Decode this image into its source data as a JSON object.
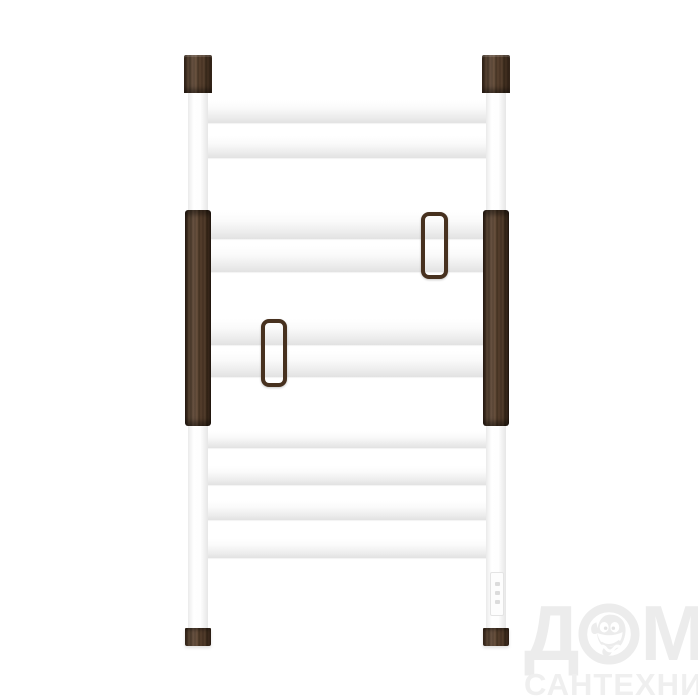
{
  "canvas": {
    "width": 698,
    "height": 698,
    "background": "#ffffff"
  },
  "product": {
    "kind": "ladder-towel-rail-photo",
    "colors": {
      "wood_dark": "#392716",
      "wood_mid": "#543b28",
      "wood_light": "#5f4530",
      "bar_highlight": "#ffffff",
      "bar_shade": "#e2e2e2",
      "hook_wood": "#47311f"
    },
    "bar_x": 200,
    "bar_w": 295,
    "bars": [
      {
        "y": 100,
        "h": 23
      },
      {
        "y": 136,
        "h": 22
      },
      {
        "y": 212,
        "h": 27
      },
      {
        "y": 246,
        "h": 26
      },
      {
        "y": 319,
        "h": 26
      },
      {
        "y": 351,
        "h": 26
      },
      {
        "y": 431,
        "h": 17
      },
      {
        "y": 466,
        "h": 19
      },
      {
        "y": 501,
        "h": 19
      },
      {
        "y": 539,
        "h": 19
      }
    ],
    "post_y": 93,
    "post_w": 20,
    "post_h": 536,
    "posts": [
      {
        "side": "left",
        "x": 188
      },
      {
        "side": "right",
        "x": 486
      }
    ],
    "cap_w": 28,
    "cap_h": 38,
    "caps": [
      {
        "x": 184,
        "y": 55
      },
      {
        "x": 482,
        "y": 55
      }
    ],
    "sleeve_w": 26,
    "sleeves": [
      {
        "x": 185,
        "y": 210,
        "h": 216
      },
      {
        "x": 483,
        "y": 210,
        "h": 216
      }
    ],
    "foot_w": 26,
    "foot_h": 18,
    "feet": [
      {
        "x": 185,
        "y": 628
      },
      {
        "x": 483,
        "y": 628
      }
    ],
    "hooks": [
      {
        "x": 421,
        "y": 212,
        "w": 19,
        "h": 59
      },
      {
        "x": 261,
        "y": 319,
        "w": 18,
        "h": 60
      }
    ],
    "control_panel": {
      "x": 490,
      "y": 572,
      "w": 14,
      "h": 44,
      "dots": 3
    }
  },
  "watermark": {
    "line1": "ДОМ",
    "word_part1": "Д",
    "word_part2": "М",
    "line2": "САНТЕХНИКИ",
    "color": "#ececec",
    "mascot": "fish-mascot-icon"
  }
}
